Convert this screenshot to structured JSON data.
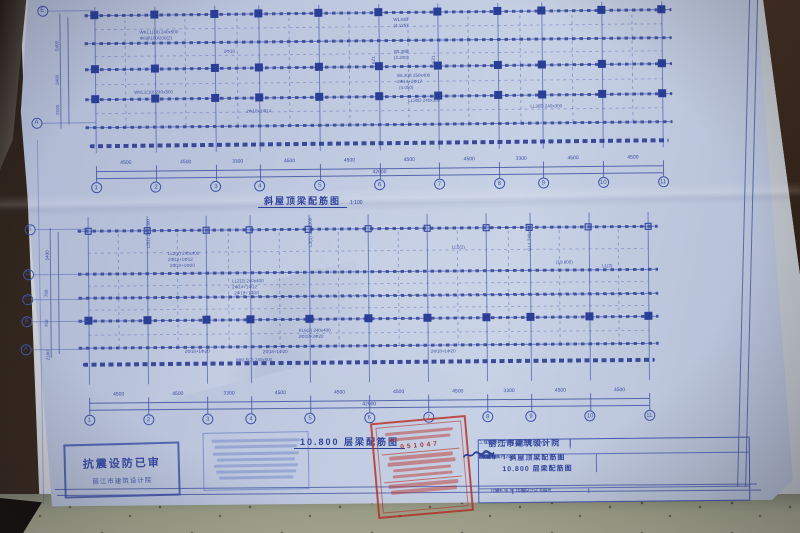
{
  "plans": [
    {
      "title": "斜屋顶梁配筋图",
      "scale": "1:100",
      "axis_numbers": [
        "1",
        "2",
        "3",
        "4",
        "5",
        "6",
        "7",
        "8",
        "9",
        "10",
        "11"
      ],
      "span_dims": [
        "4500",
        "4500",
        "3300",
        "4500",
        "4500",
        "4500",
        "4500",
        "3300",
        "4500",
        "4500"
      ],
      "total_dim": "42600",
      "row_letters": [
        "E",
        "A"
      ],
      "left_dims": [
        "5400",
        "2400",
        "2100"
      ],
      "annotations": [
        {
          "t": "WL30B",
          "x": 396,
          "y": 18
        },
        {
          "t": "(4.125)",
          "x": 396,
          "y": 24
        },
        {
          "t": "WL30B",
          "x": 396,
          "y": 50
        },
        {
          "t": "(4.200)",
          "x": 396,
          "y": 56
        },
        {
          "t": "WL30B 250x400",
          "x": 399,
          "y": 74
        },
        {
          "t": "2Φ14+2Φ12",
          "x": 399,
          "y": 80
        },
        {
          "t": "(4.050)",
          "x": 401,
          "y": 86
        },
        {
          "t": "LL30D 240x300",
          "x": 410,
          "y": 99
        },
        {
          "t": "WKL1(10) 240x500",
          "x": 142,
          "y": 28
        },
        {
          "t": "Φ8@100/200(2)",
          "x": 142,
          "y": 34
        },
        {
          "t": "2Φ18",
          "x": 226,
          "y": 48
        },
        {
          "t": "WKL2(10) 240x500",
          "x": 136,
          "y": 88
        },
        {
          "t": "2Φ16+1Φ14",
          "x": 248,
          "y": 108
        },
        {
          "t": "KZ1",
          "x": 374,
          "y": 64,
          "r": -90
        },
        {
          "t": "KZ1",
          "x": 434,
          "y": 64,
          "r": -90
        },
        {
          "t": "LL30D 240x300",
          "x": 532,
          "y": 106
        }
      ]
    },
    {
      "title": "10.800 层梁配筋图",
      "scale": "",
      "axis_numbers": [
        "1",
        "2",
        "3",
        "4",
        "5",
        "6",
        "7",
        "8",
        "9",
        "10",
        "11"
      ],
      "span_dims": [
        "4500",
        "4500",
        "3300",
        "4500",
        "4500",
        "4500",
        "4500",
        "3300",
        "4500",
        "4500"
      ],
      "total_dim": "42600",
      "row_letters": [
        "E",
        "D",
        "C",
        "B",
        "A"
      ],
      "left_dims": [
        "5400",
        "780",
        "750",
        "2100"
      ],
      "annotations": [
        {
          "t": "LL2(2) 240x400",
          "x": 168,
          "y": 250
        },
        {
          "t": "2Φ14+1Φ12",
          "x": 168,
          "y": 256
        },
        {
          "t": "2Φ18+1Φ20",
          "x": 170,
          "y": 262
        },
        {
          "t": "LL2(2) 240x400",
          "x": 232,
          "y": 278
        },
        {
          "t": "2Φ14+1Φ12",
          "x": 232,
          "y": 284
        },
        {
          "t": "2Φ18+1Φ20",
          "x": 234,
          "y": 290
        },
        {
          "t": "KL6(2) 240x400",
          "x": 298,
          "y": 328
        },
        {
          "t": "2Φ18+2Φ20",
          "x": 298,
          "y": 334
        },
        {
          "t": "2Φ18+1Φ20",
          "x": 184,
          "y": 348
        },
        {
          "t": "2Φ18+1Φ20",
          "x": 262,
          "y": 349
        },
        {
          "t": "2Φ18+1Φ20",
          "x": 430,
          "y": 350
        },
        {
          "t": "WKL5(2) 240x500",
          "x": 235,
          "y": 357
        },
        {
          "t": "L3(1) 240x300",
          "x": 147,
          "y": 246,
          "r": -90
        },
        {
          "t": "L3(1) 240x300",
          "x": 309,
          "y": 246,
          "r": -90
        },
        {
          "t": "GL1 240x300",
          "x": 528,
          "y": 252,
          "r": -90
        },
        {
          "t": "LL2(2)",
          "x": 452,
          "y": 246
        },
        {
          "t": "(10.800)",
          "x": 556,
          "y": 262
        },
        {
          "t": "L1(2)",
          "x": 602,
          "y": 266
        }
      ]
    }
  ],
  "title_block": {
    "institute": "丽江市建筑设计院",
    "project_label": "工程名称",
    "project_name": "宁蒗县宁利完小",
    "code_label": "工程代号",
    "code_value": "",
    "drawing_name_1": "斜屋顶梁配筋图",
    "drawing_name_2": "10.800 层梁配筋图",
    "right_rows": [
      {
        "label": "单项名称",
        "value": "教学楼"
      },
      {
        "label": "图 别",
        "value": "结 施"
      },
      {
        "label": "图 号",
        "value": "5/9"
      },
      {
        "label": "日 期",
        "value": "2009年08月20日"
      }
    ],
    "sign_rows": [
      {
        "label": "审 定"
      },
      {
        "label": "审 核"
      },
      {
        "label": "校 对"
      },
      {
        "label": "设 计"
      }
    ],
    "bottom_left_label": "工程设计证书编号",
    "bottom_scale_label": "比 例",
    "bottom_pages": "第 5 张  共 10 张"
  },
  "stamps": {
    "seismic": {
      "line1": "抗震设防已审",
      "line2": "丽江市建筑设计院"
    },
    "red_review": {
      "number": "051047"
    }
  },
  "colors": {
    "blueprint_ink": "#33479e",
    "paper_blue": "#bdc7de",
    "stamp_red": "#ba2a20",
    "desk": "#9fa28a"
  }
}
